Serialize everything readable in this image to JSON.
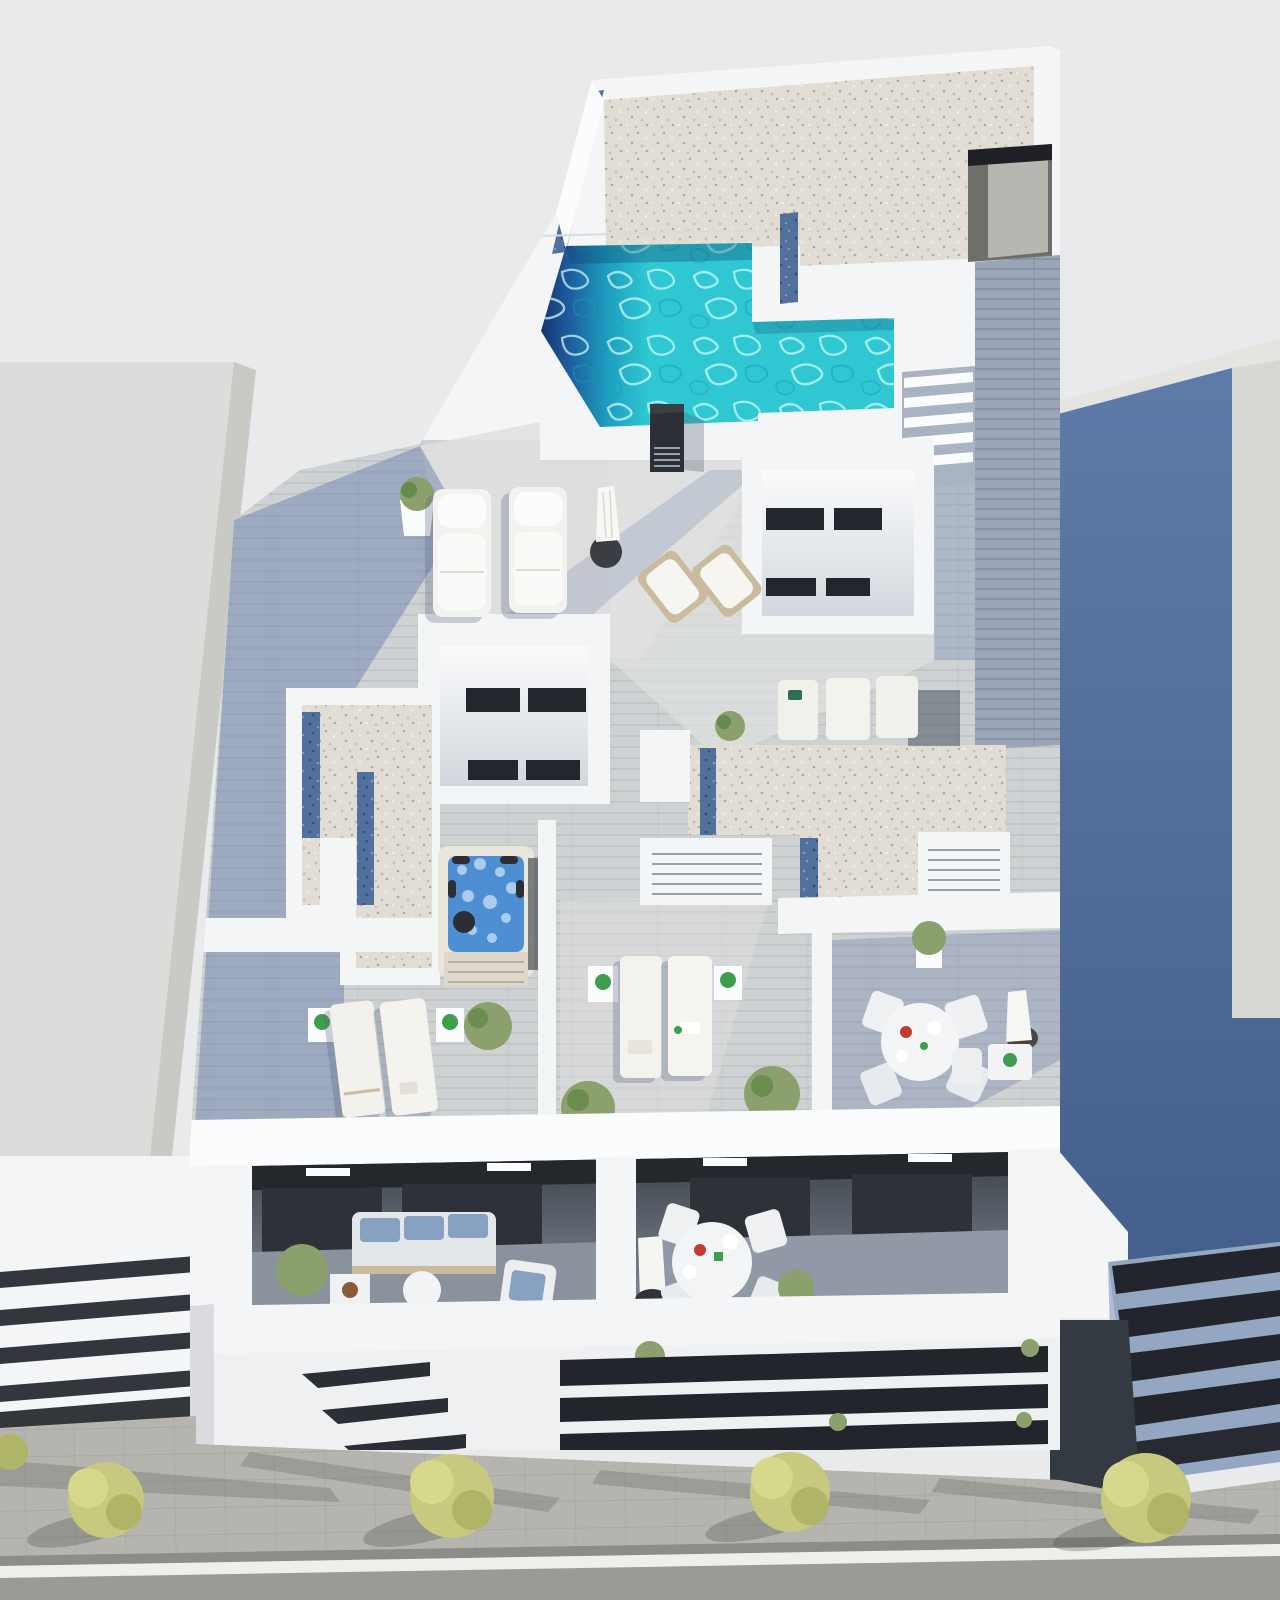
{
  "scene": {
    "kind": "3d-architectural-render",
    "view": "aerial-top-down",
    "subject": "new-build apartment block rooftop solarium with L-shaped pool, terraces and street below"
  },
  "palette": {
    "sky": "#e9eaec",
    "white_hi": "#fbfcfd",
    "white": "#f4f5f7",
    "white_sh": "#e3e6ea",
    "wall_line": "#d6dbe0",
    "left_bldg": "#dcdcda",
    "left_bldg_facet": "#c9c9c6",
    "gravel": "#e1ddd5",
    "gravel_dot1": "#c6c1b5",
    "gravel_dot2": "#aea89b",
    "gravel_dot3": "#f0ede6",
    "gravel_blue": "#51709c",
    "gravel_blue_d": "#2f4f7e",
    "gravel_blue_l": "#8099bb",
    "deck": "#cfd2d3",
    "deck_line": "#8d99ad",
    "deck_sun": "#e0e1df",
    "shadow_soft": "#6e82ab",
    "walkway": "#9aa5b6",
    "walkway_line": "#5f6d86",
    "pool_teal": "#2fc8d2",
    "pool_mid": "#1d9fc0",
    "pool_navy": "#16346f",
    "ripple_light": "#c9f7f5",
    "ripple_dark": "#129cb4",
    "window_dark": "#23272d",
    "recess_top": "#3c4148",
    "recess_floor": "#828b97",
    "blue_wall_1": "#5e7aa9",
    "blue_wall_2": "#45608d",
    "right_roof": "#d7d7d3",
    "right_band_light": "#93a6c2",
    "band_dark": "#22262c",
    "tree1": "#c7c97e",
    "tree2": "#b0b466",
    "tree3": "#d6d88c",
    "sidewalk": "#b5b4af",
    "paver": "#a19f99",
    "road": "#9b9a96",
    "road_line": "#edefed",
    "curb": "#8c8c88",
    "tub_rim": "#e9e6dc",
    "tub_water": "#4e8ed2",
    "tub_foam": "#bcd8f2",
    "tub_dark": "#2b2f35",
    "tub_step": "#ddd8cb",
    "wood": "#cabb9e",
    "cushion_blue": "#87a1c2",
    "sofa": "#e4e7ea",
    "plant_green": "#8ba06c",
    "plant_green_d": "#56803e",
    "plant_bright": "#3f9e4e",
    "red_item": "#c43a2e",
    "umbrella_base": "#3a3d42",
    "door": "#b7b6b0",
    "door_gap": "#1f2126",
    "louver": "#9aa0a8"
  },
  "objects": {
    "rooftop_pool": {
      "label": "L-shaped swimming pool",
      "count": 1
    },
    "hot_tub": {
      "label": "square hot tub with steps",
      "count": 1
    },
    "padded_loungers": {
      "label": "padded sun loungers",
      "count": 2
    },
    "flat_loungers": {
      "label": "flat sun loungers",
      "count": 7
    },
    "deck_chairs": {
      "label": "wooden deck chairs",
      "count": 2
    },
    "closed_parasols": {
      "label": "closed parasols",
      "count": 3
    },
    "round_dining_sets": {
      "label": "round table with four chairs",
      "count": 2
    },
    "bistro_sets": {
      "label": "small table with chair",
      "count": 1
    },
    "sofa_set": {
      "label": "balcony sofa with blue cushions",
      "count": 1
    },
    "street_trees": {
      "label": "street trees",
      "count": 4
    },
    "potted_plants": {
      "label": "potted plants and shrubs",
      "count": 12
    },
    "lightwells": {
      "label": "courtyard lightwells with windows",
      "count": 2
    },
    "stairs": {
      "label": "roof access stair",
      "count": 1
    }
  }
}
